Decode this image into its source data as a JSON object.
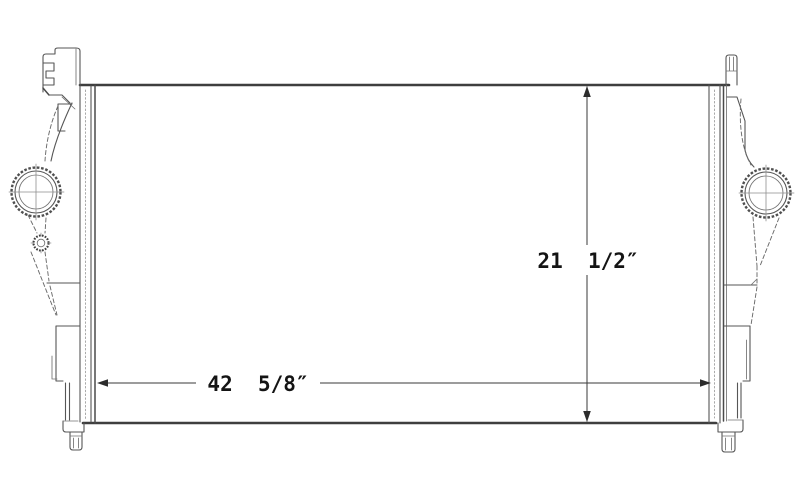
{
  "figure": {
    "background": "#ffffff",
    "line_color": "#4f4f4f",
    "text_color": "#141414",
    "annotations": {
      "height_label": "21  1/2″",
      "width_label": "42  5/8″"
    }
  }
}
